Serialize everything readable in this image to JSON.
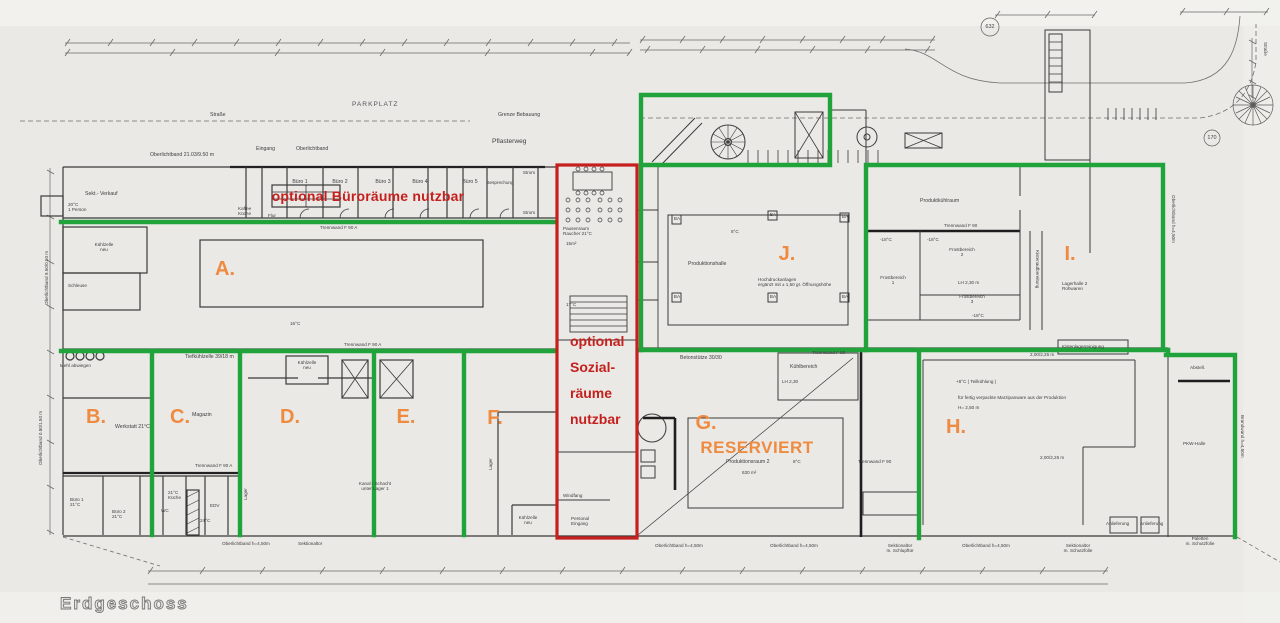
{
  "colors": {
    "paper": "#eae9e6",
    "ink": "#3d3d3d",
    "zone_green": "#1fa33a",
    "optional_red": "#c5201d",
    "zone_orange": "#ef8b41"
  },
  "floor_label": "Erdgeschoss",
  "highlights": {
    "office_note": "optional Büroräume nutzbar",
    "social_note_lines": [
      "optional",
      "Sozial-",
      "räume",
      "nutzbar"
    ],
    "reserved_label": "RESERVIERT"
  },
  "zones": [
    {
      "id": "A",
      "label": "A."
    },
    {
      "id": "B",
      "label": "B."
    },
    {
      "id": "C",
      "label": "C."
    },
    {
      "id": "D",
      "label": "D."
    },
    {
      "id": "E",
      "label": "E."
    },
    {
      "id": "F",
      "label": "F."
    },
    {
      "id": "G",
      "label": "G."
    },
    {
      "id": "H",
      "label": "H."
    },
    {
      "id": "I",
      "label": "I."
    },
    {
      "id": "J",
      "label": "J."
    }
  ],
  "circled_numbers": {
    "n632": "632",
    "n170": "170"
  },
  "plan_labels": {
    "oberlichtband_main": "Oberlichtband 21.03/9.50 m",
    "eingang_top": "Eingang",
    "oberlichtband_small": "Oberlichtband",
    "parkplatz": "PARKPLATZ",
    "strasse_left": "Straße",
    "grenze_bebauung": "Grenze Bebauung",
    "pflasterweg": "Pflasterweg",
    "buero1": "Büro 1",
    "buero2": "Büro 2",
    "buero3": "Büro 3",
    "buero4": "Büro 4",
    "buero5": "Büro 5",
    "besprechung": "Besprechung",
    "strom_top": "Strom",
    "strom_bottom": "Strom",
    "kaffee_kueche": "Kaffee\nKüche",
    "flur": "Flur",
    "trennwand_f90a_top": "Trennwand F 90 A",
    "sekt_verkauf": "Sekt.- Verkauf",
    "person_20c": "20°C\n1 Person",
    "kuehlzelle_neu_a": "Kühlzelle\nneu",
    "schleuse": "Schleuse",
    "temp_16c": "16°C",
    "mehl_abwiegen": "Mehl abwiegen",
    "tiefkuehlzelle": "Tiefkühlzelle 39/18 m",
    "werkstatt": "Werkstatt 21°C",
    "magazin": "Magazin",
    "kuehlzelle_neu_d": "Kühlzelle\nneu",
    "kanal_schacht": "Kanal / Schacht\nunter Lager 1",
    "lager_vert_c": "Lager",
    "lager_vert_f": "Lager",
    "kuehlzelle_neu_f": "Kühlzelle\nneu",
    "trennwand_f90a_b": "Trennwand F 90 A",
    "trennwand_f90a_row": "Trennwand F 90 A",
    "buero1_eg": "Büro 1\n21°C",
    "buero2_eg": "Büro 2\n21°C",
    "kueche": "21°C\nKüche",
    "wc": "WC",
    "edv": "EDV",
    "temp_24c": "24°C",
    "oberlichtband_h450_1": "Oberlichtband h=4,50m",
    "sektionaltor": "Sektionaltor",
    "pausenraum": "Pausenraum\nRaucher 21°C",
    "qm15": "15m²",
    "temp_17c": "17°C",
    "windfang": "Windfang",
    "personal_eingang": "Personal\nEingang",
    "betonstuetze": "Betonstütze 30/30",
    "kuehlbereich": "Kühlbereich",
    "lh_230": "LH 2,30",
    "trennwand_f90_g1": "Trennwand F 90",
    "trennwand_f90_g2": "Trennwand F 90",
    "produktionsraum2": "Produktionsraum 2",
    "temp_8c_g": "8°C",
    "qm630": "630 m²",
    "produktionshalle": "Produktionshalle",
    "temp_8c_j": "8°C",
    "hochdruckanlagen": "Hochdruckanlagen\nergänzt mit ± 1,50 gr. Öffnungshöhe",
    "produktkuehlraum": "Produktkühlraum",
    "trennwand_f90_i": "Trennwand F 90",
    "temp_m18_1": "-18°C",
    "temp_m18_2": "-18°C",
    "temp_m18_3": "-18°C",
    "frostbereich1": "Frostbereich\n1",
    "frostbereich2": "Frostbereich\n2",
    "frostbereich3": "Frostbereich\n3",
    "lh_230_i": "LH 2,30 m",
    "lagerhalle2": "Lagerhalle 2\nRohwaren",
    "kistenaufbereitung": "Kistenaufbereitung",
    "kistenlagerreinigung": "Kistenlagerreinigung",
    "teilkuehlung": "+8°C  ( Teilkühlung )",
    "verpackte_ware": "für fertig verpackte Marzipanware aus der Produktion",
    "h_250": "H= 2,50 m",
    "dim_200_226_top": "2,00/2,26 m",
    "dim_200_226_mid": "2,00/2,26 m",
    "abstell": "Abstell.",
    "pkw_halle": "PKW-Halle",
    "paletten": "Paletten\nm. Schutzfolie",
    "brandwand": "Brandwand h=4,50m",
    "anlieferung1": "Anlieferung",
    "anlieferung2": "Anlieferung",
    "oberlichtband_h450_2": "Oberlichtband h=4,50m",
    "oberlichtband_h450_3": "Oberlichtband h=4,50m",
    "oberlichtband_h450_4": "Oberlichtband h=4,50m",
    "schlupftuer": "Sektionaltor\nm. Schlupftür",
    "schutzfolie_tor": "Sektionaltor\nm. Schutzfolie",
    "oberlichtband_left1": "Oberlichtband 9.50/0.50 m",
    "oberlichtband_left2": "Oberlichtband 0.80/1.50 m",
    "oberlichtband_right": "Oberlichtband h=4,50m",
    "strasse_right": "Straße",
    "ba": "BA"
  }
}
